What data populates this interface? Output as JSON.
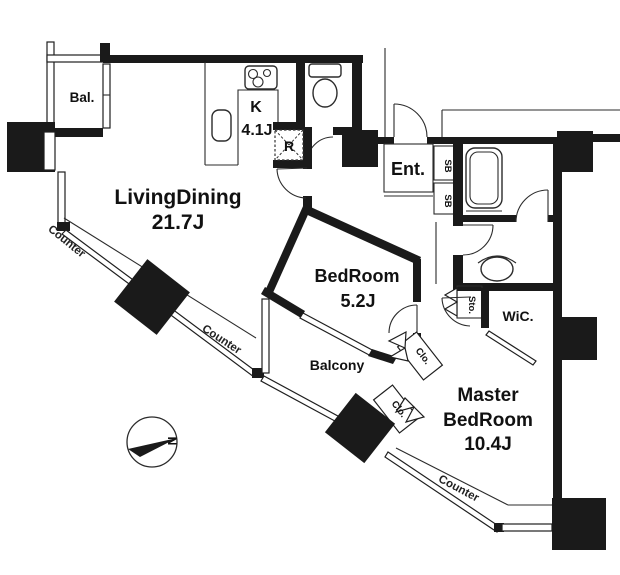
{
  "floorplan": {
    "rooms": {
      "living_dining": {
        "name": "LivingDining",
        "area": "21.7J"
      },
      "kitchen": {
        "name": "K",
        "area": "4.1J"
      },
      "bedroom": {
        "name": "BedRoom",
        "area": "5.2J"
      },
      "master_bedroom": {
        "name_line1": "Master",
        "name_line2": "BedRoom",
        "area": "10.4J"
      },
      "entrance": {
        "name": "Ent."
      },
      "walk_in_closet": {
        "name": "WiC."
      },
      "storage": {
        "name": "Sto."
      },
      "refrigerator_space": {
        "name": "R"
      },
      "balcony_main": {
        "name": "Balcony"
      },
      "balcony_small": {
        "name": "Bal."
      }
    },
    "fixtures": {
      "shoe_box_1": "SB",
      "shoe_box_2": "SB",
      "closet_1": "Clo.",
      "closet_2": "Clo."
    },
    "annotations": {
      "counter_1": "Counter",
      "counter_2": "Counter",
      "counter_3": "Counter",
      "compass_north": "N"
    },
    "icons": {
      "stove": "stove-icon",
      "kitchen_sink": "sink-icon",
      "toilet": "toilet-icon",
      "bathtub": "bathtub-icon",
      "washbasin": "washbasin-icon",
      "compass": "compass-icon"
    },
    "colors": {
      "wall": "#1a1a1a",
      "line": "#2b2b2b",
      "background": "#ffffff"
    }
  }
}
